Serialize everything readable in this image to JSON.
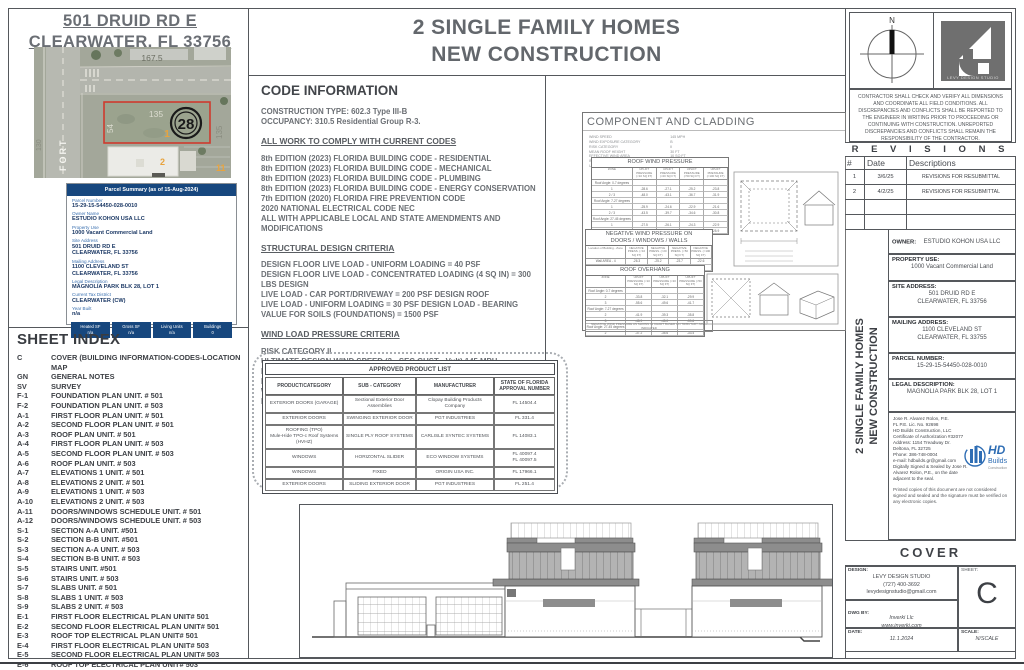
{
  "header": {
    "site_title": "501 DRUID RD E\nCLEARWATER, FL 33756",
    "main_title": "2 SINGLE FAMILY HOMES\nNEW CONSTRUCTION"
  },
  "map": {
    "street_name": "FORT",
    "labels": {
      "top_dim": "167.5",
      "parcel_width": "135",
      "parcel_depth": "54",
      "lot_number": "1",
      "block_circle": "28",
      "right_dim": "135",
      "left_dim": "130",
      "lot_2": "2",
      "lot_11": "11"
    }
  },
  "parcel_summary": {
    "header": "Parcel Summary (as of 15-Aug-2024)",
    "fields": [
      {
        "label": "Parcel Number",
        "value": "15-29-15-54450-028-0010"
      },
      {
        "label": "Owner Name",
        "value": "ESTUDIO KOHON USA LLC"
      },
      {
        "label": "Property Use",
        "value": "1000 Vacant Commercial Land"
      },
      {
        "label": "Site Address",
        "value": "501 DRUID RD E\nCLEARWATER, FL 33756"
      },
      {
        "label": "Mailing Address",
        "value": "1100 CLEVELAND ST\nCLEARWATER, FL 33756"
      },
      {
        "label": "Legal Description",
        "value": "MAGNOLIA PARK BLK 28, LOT 1"
      },
      {
        "label": "Current Tax District",
        "value": "CLEARWATER (CW)"
      },
      {
        "label": "Year Built",
        "value": "n/a"
      }
    ],
    "buttons": [
      {
        "label": "Heated SF",
        "value": "n/a"
      },
      {
        "label": "Gross SF",
        "value": "n/a"
      },
      {
        "label": "Living Units",
        "value": "n/a"
      },
      {
        "label": "Buildings",
        "value": "0"
      }
    ]
  },
  "sheet_index": {
    "title": "SHEET INDEX",
    "rows": [
      {
        "code": "C",
        "desc": "COVER (BUILDING INFORMATION-CODES-LOCATION MAP"
      },
      {
        "code": "GN",
        "desc": "GENERAL NOTES"
      },
      {
        "code": "SV",
        "desc": "SURVEY"
      },
      {
        "code": "F-1",
        "desc": "FOUNDATION PLAN UNIT. # 501"
      },
      {
        "code": "F-2",
        "desc": "FOUNDATION PLAN UNIT. # 503"
      },
      {
        "code": "A-1",
        "desc": "FIRST FLOOR PLAN UNIT. # 501"
      },
      {
        "code": "A-2",
        "desc": "SECOND FLOOR PLAN UNIT. # 501"
      },
      {
        "code": "A-3",
        "desc": "ROOF PLAN UNIT. # 501"
      },
      {
        "code": "A-4",
        "desc": "FIRST FLOOR PLAN UNIT. # 503"
      },
      {
        "code": "A-5",
        "desc": "SECOND FLOOR PLAN UNIT. # 503"
      },
      {
        "code": "A-6",
        "desc": "ROOF PLAN UNIT. # 503"
      },
      {
        "code": "A-7",
        "desc": "ELEVATIONS 1 UNIT. # 501"
      },
      {
        "code": "A-8",
        "desc": "ELEVATIONS 2 UNIT. # 501"
      },
      {
        "code": "A-9",
        "desc": "ELEVATIONS 1 UNIT. # 503"
      },
      {
        "code": "A-10",
        "desc": "ELEVATIONS 2 UNIT. # 503"
      },
      {
        "code": "A-11",
        "desc": "DOORS/WINDOWS SCHEDULE UNIT. # 501"
      },
      {
        "code": "A-12",
        "desc": "DOORS/WINDOWS SCHEDULE UNIT. # 503"
      },
      {
        "code": "S-1",
        "desc": "SECTION A-A UNIT. #501"
      },
      {
        "code": "S-2",
        "desc": "SECTION B-B UNIT. #501"
      },
      {
        "code": "S-3",
        "desc": "SECTION A-A UNIT. # 503"
      },
      {
        "code": "S-4",
        "desc": "SECTION B-B UNIT. # 503"
      },
      {
        "code": "S-5",
        "desc": "STAIRS UNIT. #501"
      },
      {
        "code": "S-6",
        "desc": "STAIRS UNIT. # 503"
      },
      {
        "code": "S-7",
        "desc": "SLABS UNIT. # 501"
      },
      {
        "code": "S-8",
        "desc": "SLABS 1 UNIT. # 503"
      },
      {
        "code": "S-9",
        "desc": "SLABS 2 UNIT. # 503"
      },
      {
        "code": "E-1",
        "desc": "FIRST FLOOR ELECTRICAL PLAN   UNIT# 501"
      },
      {
        "code": "E-2",
        "desc": "SECOND FLOOR ELECTRICAL PLAN   UNIT# 501"
      },
      {
        "code": "E-3",
        "desc": "ROOF TOP ELECTRICAL PLAN   UNIT# 501"
      },
      {
        "code": "E-4",
        "desc": "FIRST FLOOR ELECTRICAL PLAN   UNIT# 503"
      },
      {
        "code": "E-5",
        "desc": "SECOND FLOOR ELECTRICAL PLAN   UNIT# 503"
      },
      {
        "code": "E-6",
        "desc": "ROOF TOP ELECTRICAL PLAN   UNIT# 503"
      }
    ]
  },
  "code_info": {
    "title": "CODE INFORMATION",
    "general": [
      "CONSTRUCTION TYPE:   602.3 Type III-B",
      "OCCUPANCY: 310.5 Residential Group R-3."
    ],
    "codes_heading": "ALL WORK TO COMPLY WITH CURRENT CODES",
    "codes": [
      "8th EDITION (2023) FLORIDA BUILDING CODE - RESIDENTIAL",
      "8th EDITION (2023) FLORIDA BUILDING CODE - MECHANICAL",
      "8th EDITION (2023) FLORIDA BUILDING CODE - PLUMBING",
      "8th EDITION (2023) FLORIDA BUILDING CODE - ENERGY CONSERVATION",
      "7th EDITION (2020) FLORIDA FIRE PREVENTION CODE",
      "2020 NATIONAL ELECTRICAL CODE NEC",
      "ALL WITH APPLICABLE LOCAL AND STATE AMENDMENTS AND MODIFICATIONS"
    ],
    "structural_heading": "STRUCTURAL DESIGN CRITERIA",
    "structural": [
      "DESIGN FLOOR LIVE LOAD - UNIFORM LOADING = 40 PSF",
      "DESIGN FLOOR LIVE LOAD - CONCENTRATED LOADING (4 SQ IN) = 300 LBS DESIGN",
      " LIVE LOAD - CAR PORT/DRIVEWAY = 200 PSF DESIGN ROOF",
      "LIVE LOAD - UNIFORM LOADING = 30 PSF DESIGN LOAD - BEARING VALUE FOR SOILS (FOUNDATIONS) = 1500 PSF"
    ],
    "wind_heading": "WIND LOAD PRESSURE CRITERIA",
    "wind": [
      "RISK CATEGORY II",
      "ULTIMATE DESIGN WIND SPEED (3 - SEC GUST - Vult) 145 MPH",
      "NOMINAL DESIGN WIND SPEED (Vasd) 108 MPH",
      "DO WIND-BORNE DEBRIS PROVISIONS APPLY YES",
      "WIND EXPOSURE/SURFACE ROUGHNESS CATEGORY B",
      "INTERNAL PRESSURE COEFFICIENT (+/-) 0.18"
    ]
  },
  "component_cladding": {
    "title": "COMPONENT AND CLADDING",
    "params": [
      {
        "label": "WIND SPEED",
        "value": "145 MPH"
      },
      {
        "label": "WIND EXPOSURE CATEGORY",
        "value": "B"
      },
      {
        "label": "RISK CATEGORY",
        "value": "II"
      },
      {
        "label": "MEAN ROOF HEIGHT",
        "value": "30 FT"
      },
      {
        "label": "EFFECTIVE WIND AREA",
        "value": "10 SQ FT"
      },
      {
        "label": "INTERNAL PRESSURE COEFF. (GCpi)",
        "value": "+/- 0.18"
      },
      {
        "label": "ULT. DESIGN WIND PRESSURE P (ULT)",
        "value": "1,000 psf"
      }
    ],
    "roof_table": {
      "title": "ROOF WIND PRESSURE",
      "headers": [
        "ZONE",
        "UPLIFT PRESSURE (<10 SQ FT)",
        "UPLIFT PRESSURE (<20 SQ FT)",
        "UPLIFT PRESSURE (<50 SQ FT)",
        "UPLIFT PRESSURE (<100 SQ FT)"
      ],
      "rows": [
        [
          "Roof Angle: 0-7 degrees",
          "",
          "",
          "",
          ""
        ],
        [
          "1",
          "-28.6",
          "-27.1",
          "-25.2",
          "-23.8"
        ],
        [
          "2 / 3",
          "-48.0",
          "-43.1",
          "-36.7",
          "-31.9"
        ],
        [
          "Roof Angle: 7-27 degrees",
          "",
          "",
          "",
          ""
        ],
        [
          "1",
          "-25.9",
          "-24.6",
          "-22.9",
          "-21.6"
        ],
        [
          "2 / 3",
          "-43.5",
          "-39.7",
          "-34.6",
          "-30.8"
        ],
        [
          "Roof Angle: 27-45 degrees",
          "",
          "",
          "",
          ""
        ],
        [
          "1",
          "-27.5",
          "-26.1",
          "-24.3",
          "-22.9"
        ],
        [
          "2 / 3",
          "-32.1",
          "-30.3",
          "-27.8",
          "-25.9"
        ]
      ]
    },
    "negative_table": {
      "title": "NEGATIVE WIND PRESSURE ON\nDOORS / WINDOWS / WALLS",
      "headers": [
        "Location of Building - Zone",
        "NEGATIVE PRESS. (<10 SQ FT)",
        "NEGATIVE PRESS. (<20 SQ FT)",
        "NEGATIVE PRESS. (<50 SQ FT)",
        "NEGATIVE PRESS. (<100 SQ FT)"
      ],
      "rows": [
        [
          "Wall  AREA - 4",
          "-26.3",
          "-25.2",
          "-23.7",
          "-22.6"
        ],
        [
          "CORNER AREA - 5",
          "-32.4",
          "-30.1",
          "-27.0",
          "-24.7"
        ]
      ]
    },
    "overhang_table": {
      "title": "ROOF OVERHANG",
      "headers": [
        "ZONE",
        "UPLIFT PRESSURE (<10 SQ FT)",
        "UPLIFT PRESSURE (<20 SQ FT)",
        "UPLIFT PRESSURE (<50 SQ FT)"
      ],
      "rows": [
        [
          "Roof Angle: 0-7 degrees",
          "",
          "",
          ""
        ],
        [
          "2",
          "-33.8",
          "-32.1",
          "-29.9"
        ],
        [
          "3",
          "-55.6",
          "-49.6",
          "-41.7"
        ],
        [
          "Roof Angle: 7-27 degrees",
          "",
          "",
          ""
        ],
        [
          "2",
          "-41.9",
          "-39.3",
          "-35.8"
        ],
        [
          "3",
          "-48.9",
          "-45.0",
          "-39.8"
        ],
        [
          "Roof Angle: 27-45 degrees",
          "",
          "",
          ""
        ],
        [
          "2",
          "-37.2",
          "-35.6",
          "-33.4"
        ]
      ]
    },
    "note": "NEGATIVE WIND PRESSURE AS SHOWN IN CHART BASED ON TRIBUTARY AREA INDICATED"
  },
  "approved_products": {
    "title": "APPROVED PRODUCT LIST",
    "headers": [
      "PRODUCT/CATEGORY",
      "SUB - CATEGORY",
      "MANUFACTURER",
      "STATE OF FLORIDA APPROVAL NUMBER"
    ],
    "rows": [
      [
        "EXTERIOR DOORS (GARAGE)",
        "Sectional Exterior Door Assemblies",
        "Clopay Building Products Company",
        "FL 14504.4"
      ],
      [
        "EXTERIOR DOORS",
        "SWINGING EXTERIOR DOOR",
        "PGT INDUSTRIES",
        "FL 331.4"
      ],
      [
        "ROOFING (TPO)\nMule-Hide TPO-c Roof Systems\n(HVHZ)",
        "SINGLE PLY ROOF SYSTEMS",
        "CARLISLE SYNTEC SYSTEMS",
        "FL 14083.1"
      ],
      [
        "WINDOWS",
        "HORIZONTAL SLIDER",
        "ECO WINDOW SYSTEMS",
        "FL 40097.4\nFL 40097.5"
      ],
      [
        "WINDOWS",
        "FIXED",
        "ORIGIN USA INC.",
        "FL 17966.1"
      ],
      [
        "EXTERIOR DOORS",
        "SLIDING EXTERIOR DOOR",
        "PGT INDUSTRIES",
        "FL 251.4"
      ]
    ]
  },
  "compass": {
    "north_label": "N"
  },
  "logos": {
    "levy": "LEVY DESIGN STUDIO",
    "hd_top": "HD",
    "hd_mid": "Builds",
    "hd_bottom": "Construction"
  },
  "contractor_note": "CONTRACTOR SHALL CHECK AND VERIFY ALL DIMENSIONS AND COORDINATE ALL FIELD CONDITIONS. ALL DISCREPANCIES AND CONFLICTS SHALL BE REPORTED TO THE ENGINEER IN WRITING PRIOR TO PROCEEDING OR CONTINUING WITH CONSTRUCTION. UNREPORTED DISCREPANCIES AND CONFLICTS SHALL REMAIN THE RESPONSIBILITY OF THE CONTRACTOR.",
  "revisions": {
    "title": "R E V I S I O N S",
    "headers": [
      "#",
      "Date",
      "Descriptions"
    ],
    "rows": [
      [
        "1",
        "3/6/25",
        "REVISIONS FOR RESUBMITTAL"
      ],
      [
        "2",
        "4/2/25",
        "REVISIONS FOR RESUBMITTAL"
      ],
      [
        "",
        "",
        ""
      ],
      [
        "",
        "",
        ""
      ]
    ]
  },
  "project": {
    "owner_label": "OWNER:",
    "owner": "ESTUDIO KOHON USA LLC",
    "property_use_label": "PROPERTY USE:",
    "property_use": "1000 Vacant Commercial Land",
    "site_address_label": "SITE ADDRESS:",
    "site_address": "501 DRUID RD E\nCLEARWATER, FL 33756",
    "mailing_address_label": "MAILING ADDRESS:",
    "mailing_address": "1100 CLEVELAND ST\nCLEARWATER, FL 33755",
    "parcel_number_label": "PARCEL NUMBER:",
    "parcel_number": "15-29-15-54450-028-0010",
    "legal_label": "LEGAL DESCRIPTION:",
    "legal": "MAGNOLIA PARK BLK 28, LOT 1",
    "vertical_title": "2 SINGLE FAMILY HOMES\nNEW CONSTRUCTION"
  },
  "engineer": {
    "lines": [
      "Jose R. Alvarez Rolon, P.E.",
      "FL P.E. Lic. No. 92698",
      "HD Builds Construction, LLC",
      "Certificate of Authorization #32077",
      "Address: 1154 Treadway Dr.",
      "Deltona, FL 32725",
      "Phone: 386-748-0004",
      "e-mail: hdbuilds.gr@gmail.com",
      "Digitally Signed & Sealed by Jose R. Alvarez Rolon, P.E., on the date adjacent to the seal."
    ],
    "note": "Printed copies of this document are not considered signed and sealed and the signature must be verified on any electronic copies."
  },
  "titleblock": {
    "cover": "COVER",
    "design_label": "DESIGN:",
    "design": "LEVY DESIGN STUDIO\n(727) 400-3692\nlevydesignstudio@gmail.com",
    "dwg_label": "DWG BY:",
    "dwg": "Inverki Llc\nwww.inverki.com\n727-4217385",
    "date_label": "DATE:",
    "date": "11.1.2024",
    "scale_label": "SCALE:",
    "scale": "N/SCALE",
    "sheet_label": "SHEET:",
    "sheet": "C"
  }
}
